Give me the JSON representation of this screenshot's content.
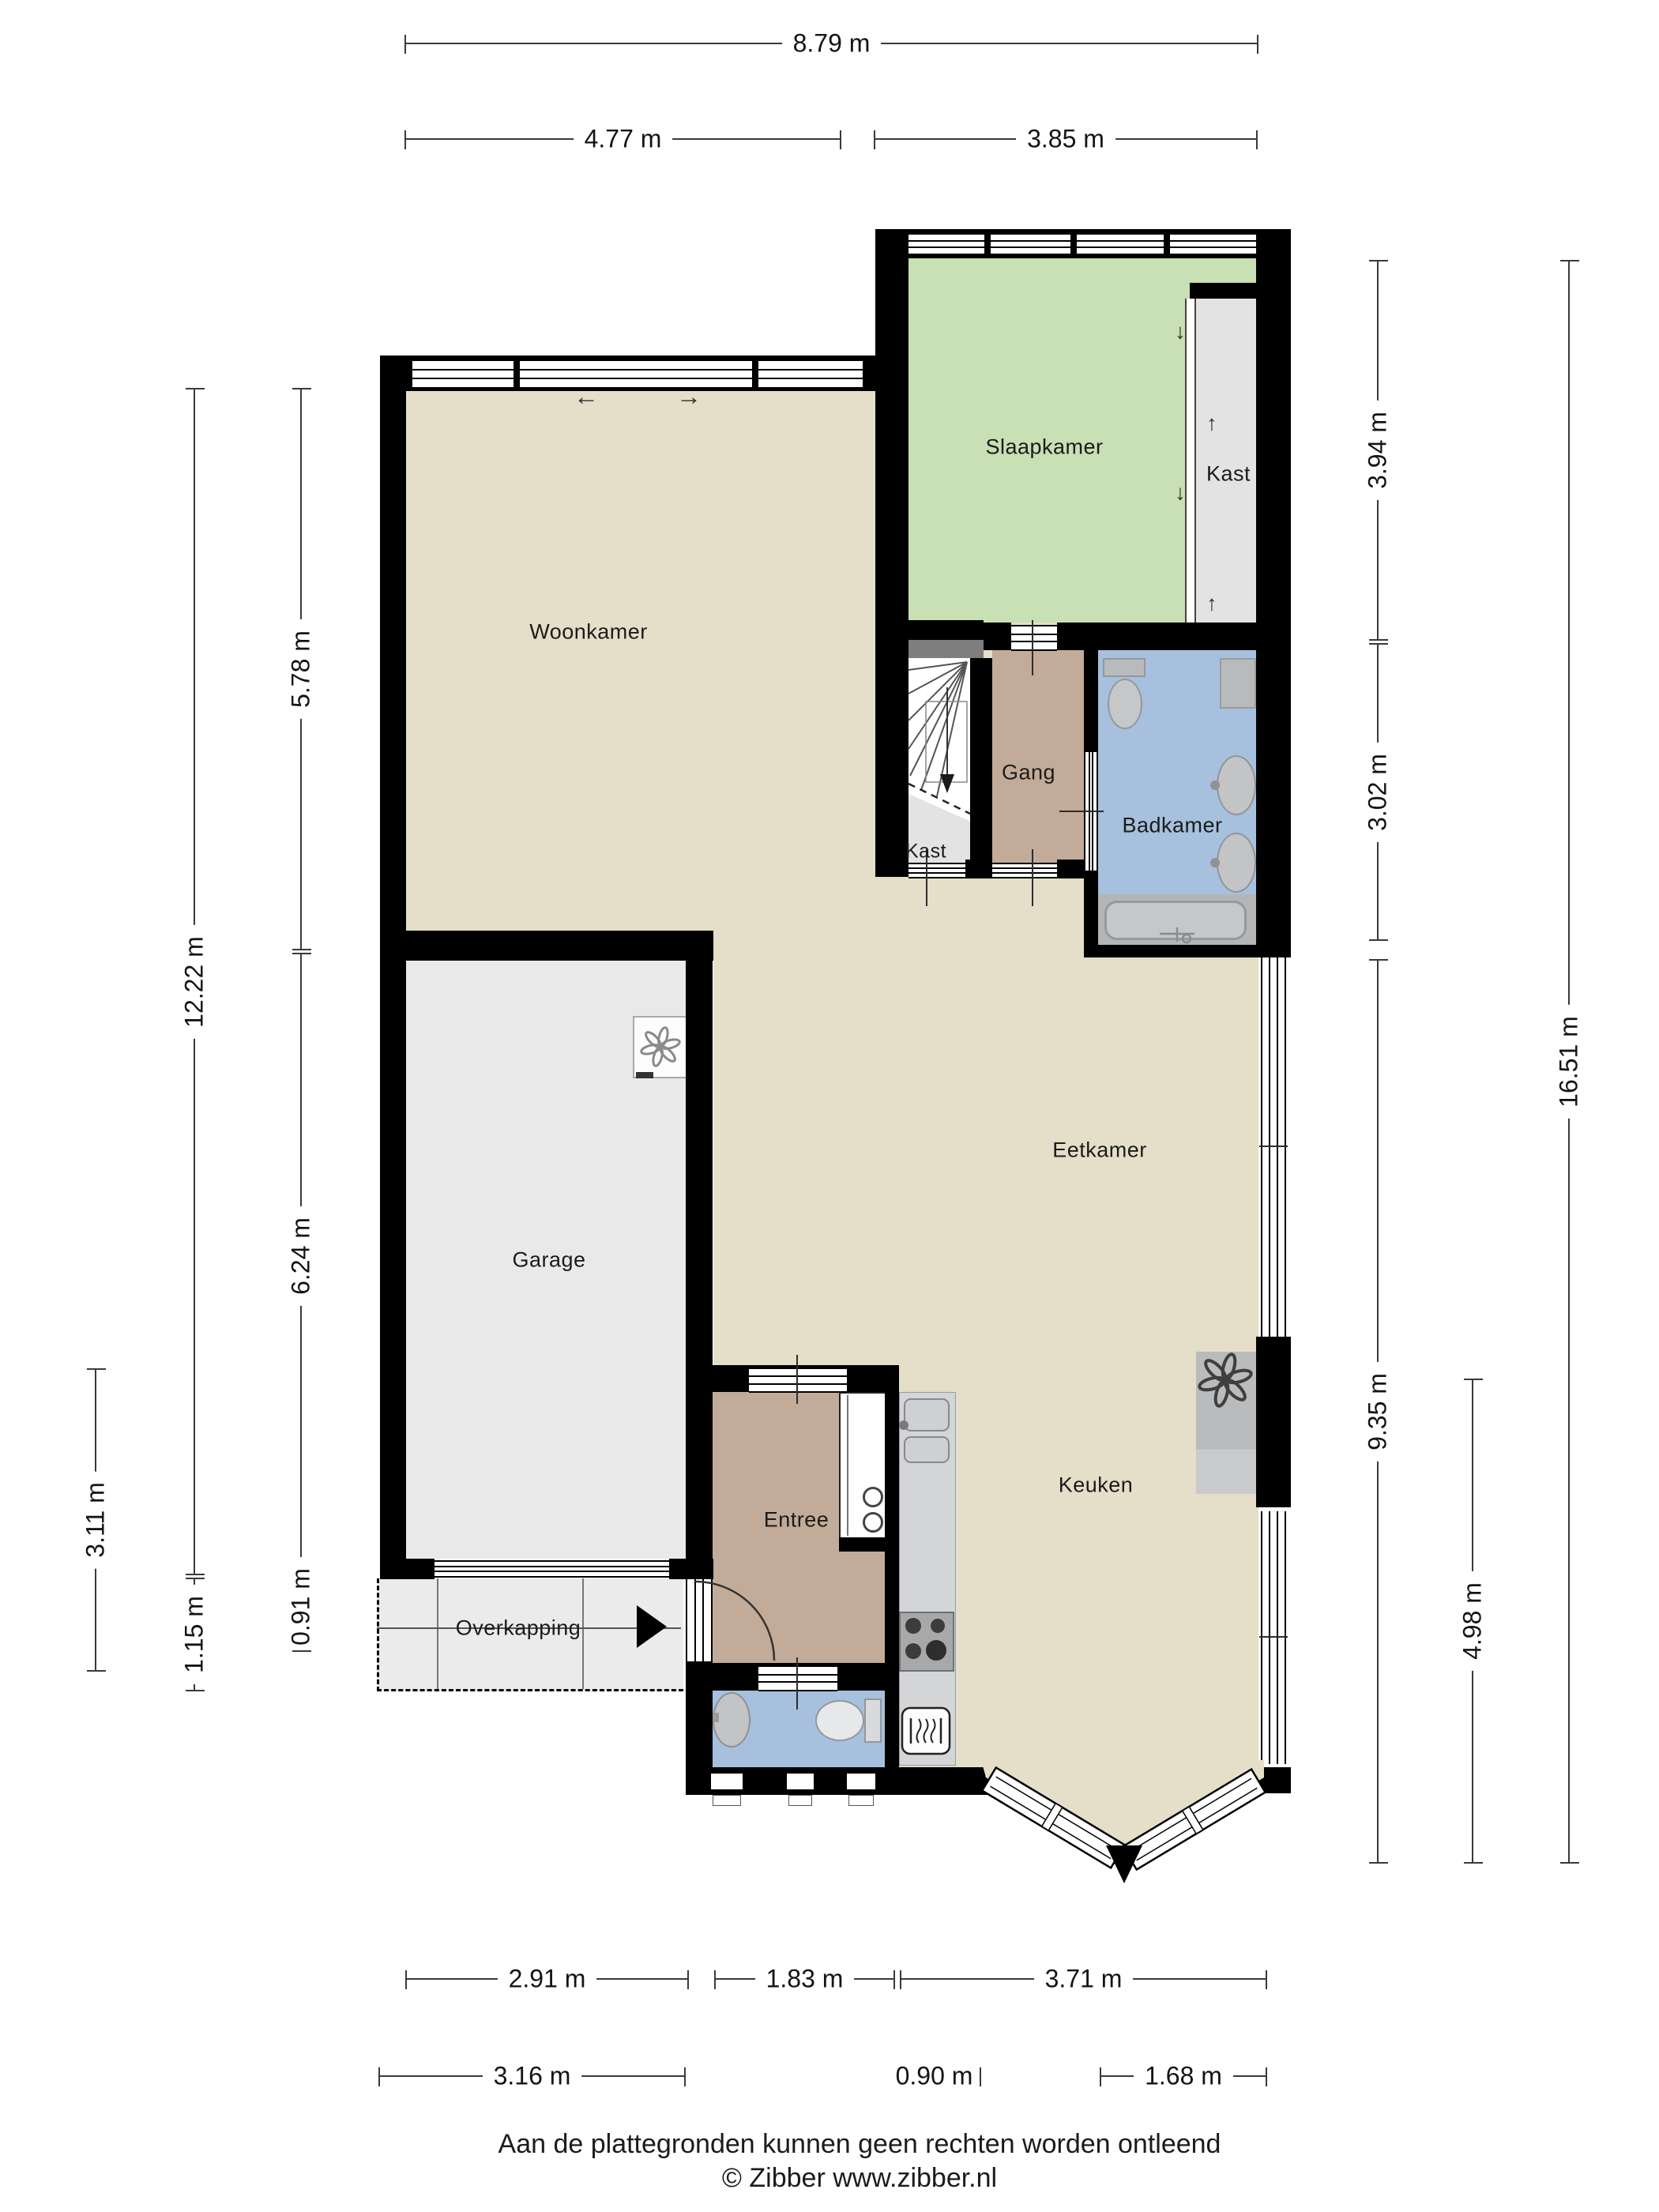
{
  "rooms": {
    "woonkamer": "Woonkamer",
    "slaapkamer": "Slaapkamer",
    "kast_bedroom": "Kast",
    "gang": "Gang",
    "badkamer": "Badkamer",
    "kast_hall": "Kast",
    "eetkamer": "Eetkamer",
    "garage": "Garage",
    "entree": "Entree",
    "keuken": "Keuken",
    "overkapping": "Overkapping"
  },
  "dimensions": {
    "top": [
      "8.79 m",
      "4.77 m",
      "3.85 m"
    ],
    "bottom": [
      "2.91 m",
      "1.83 m",
      "3.71 m",
      "3.16 m",
      "0.90 m",
      "1.68 m"
    ],
    "left": [
      "3.11 m",
      "12.22 m",
      "1.15 m",
      "5.78 m",
      "6.24 m",
      "0.91 m"
    ],
    "right": [
      "3.94 m",
      "3.02 m",
      "9.35 m",
      "4.98 m",
      "16.51 m"
    ]
  },
  "icons": {
    "slide_left": "←",
    "slide_right": "→",
    "slide_down": "↓",
    "slide_up": "↑"
  },
  "colors": {
    "wall": "#000000",
    "floor_living": "#e5dec8",
    "floor_bedroom": "#c9dfb4",
    "floor_hall": "#c2ab98",
    "floor_bath": "#a6c0dd",
    "floor_garage": "#e9e9e9",
    "floor_closet": "#e3e3e3",
    "counter": "#d4d5d6",
    "fixture": "#c6c7c9"
  },
  "footer": {
    "line1": "Aan de plattegronden kunnen geen rechten worden ontleend",
    "line2": "© Zibber www.zibber.nl"
  }
}
